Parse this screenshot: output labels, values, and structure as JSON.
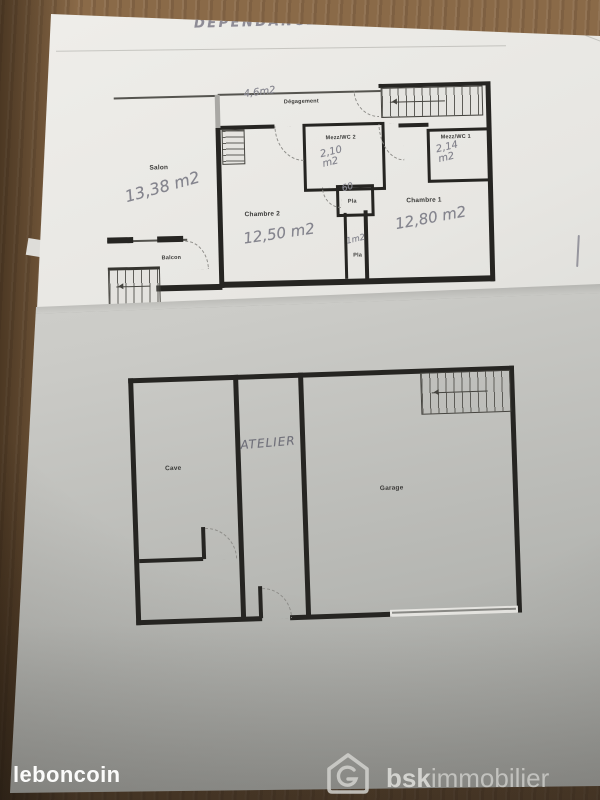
{
  "title": "DEPENDANCE",
  "plan_upper": {
    "salon": {
      "label": "Salon",
      "area": "13,38 m2"
    },
    "degagement": {
      "label": "Dégagement",
      "area": "4,6m2"
    },
    "mezz_wc_2": {
      "label": "Mezz/WC 2",
      "area": "2,10 m2"
    },
    "mezz_wc_1": {
      "label": "Mezz/WC 1",
      "area": "2,14 m2"
    },
    "chambre_2": {
      "label": "Chambre 2",
      "area": "12,50 m2"
    },
    "chambre_1": {
      "label": "Chambre 1",
      "area": "12,80 m2"
    },
    "balcon": {
      "label": "Balcon"
    },
    "placard_1": {
      "label": "Pla",
      "area": "60"
    },
    "placard_2": {
      "label": "Pla",
      "area": "1m2"
    }
  },
  "plan_lower": {
    "cave": {
      "label": "Cave"
    },
    "atelier": {
      "label": "ATELIER"
    },
    "garage": {
      "label": "Garage"
    }
  },
  "watermarks": {
    "leboncoin": "leboncoin",
    "bsk_bold": "bsk",
    "bsk_light": "immobilier"
  },
  "colors": {
    "wood": "#8a6a48",
    "paper_upper": "#e7e6e2",
    "paper_lower": "#c0c0bc",
    "wall_ink": "#262522",
    "pencil": "#84848d",
    "watermark": "#d2d2ce",
    "leboncoin_white": "#fbfbfa"
  }
}
